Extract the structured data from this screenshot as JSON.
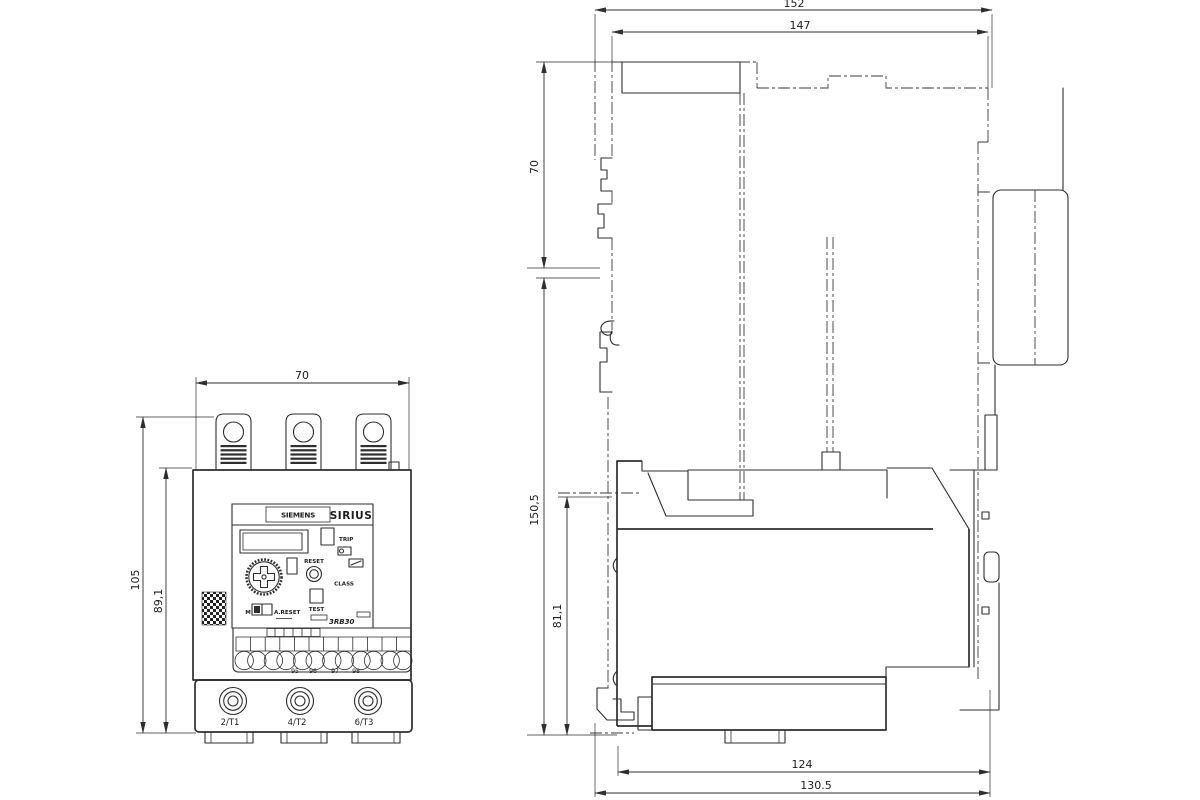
{
  "drawing": {
    "front": {
      "dim_width": "70",
      "dim_height": "105",
      "dim_body_height": "89,1",
      "brand": "SIEMENS",
      "series": "SIRIUS",
      "trip": "TRIP",
      "reset": "RESET",
      "class_label": "CLASS",
      "test": "TEST",
      "manual": "M",
      "auto_reset": "A.RESET",
      "model": "3RB30",
      "aux_terminals": [
        "95",
        "96",
        "97",
        "98"
      ],
      "main_terminals": [
        "2/T1",
        "4/T2",
        "6/T3"
      ]
    },
    "side": {
      "dim_overall_width": "152",
      "dim_width": "147",
      "dim_top_height": "70",
      "dim_height": "150,5",
      "dim_relay_height": "81,1",
      "dim_depth": "124",
      "dim_overall_depth": "130.5"
    },
    "colors": {
      "line": "#2e2e2e",
      "background": "#ffffff"
    }
  }
}
